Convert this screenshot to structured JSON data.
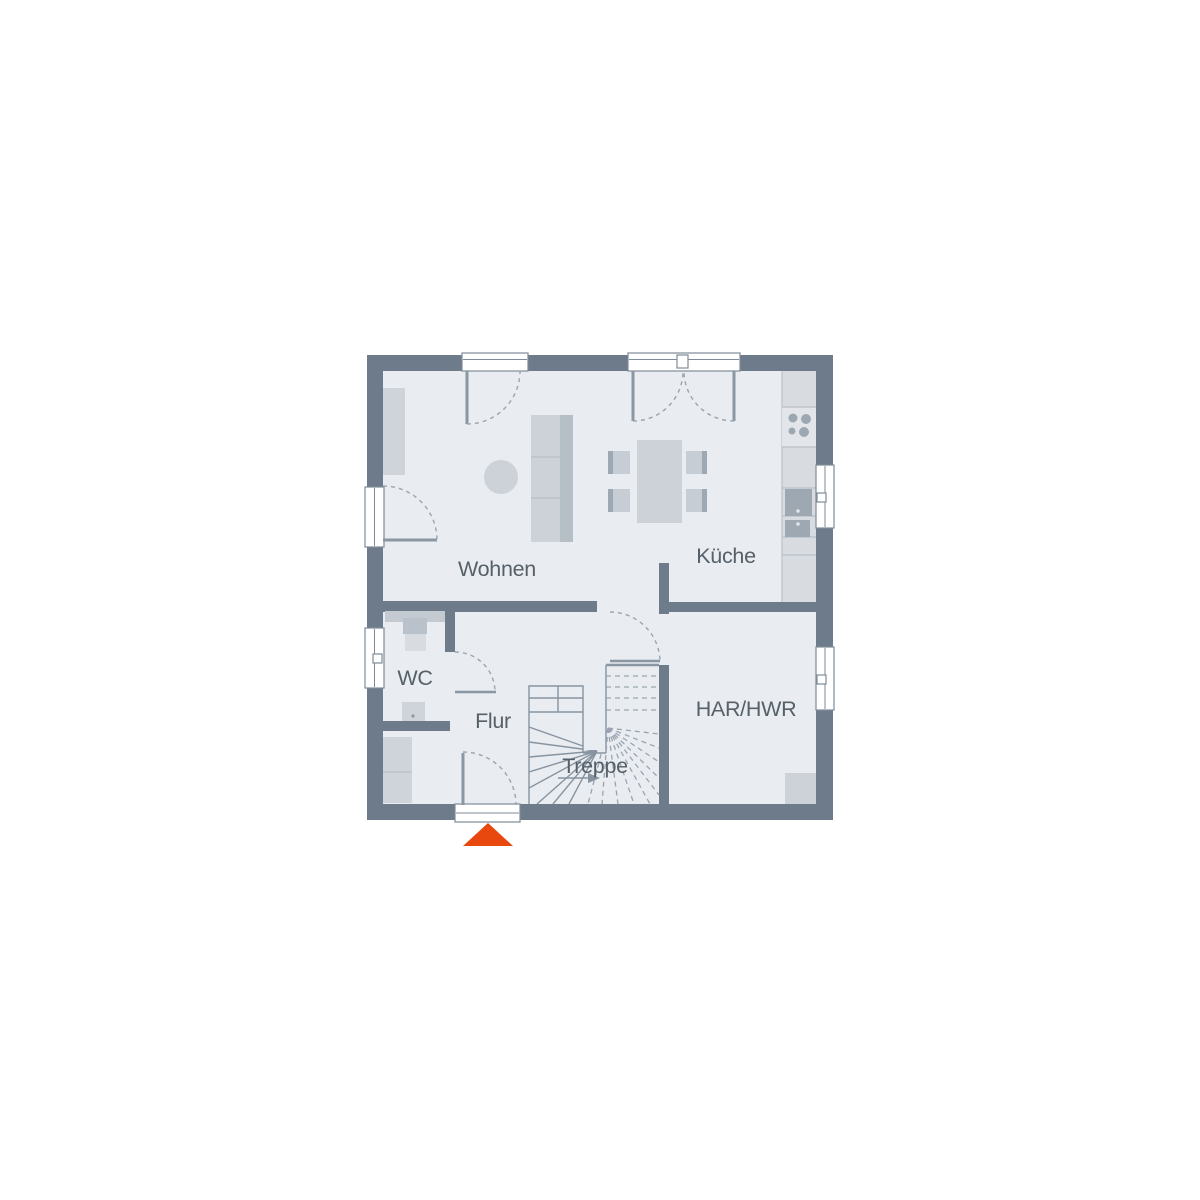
{
  "plan": {
    "type": "floor-plan-ground-floor",
    "rooms": {
      "wohnen": {
        "label": "Wohnen"
      },
      "kueche": {
        "label": "Küche"
      },
      "wc": {
        "label": "WC"
      },
      "flur": {
        "label": "Flur"
      },
      "treppe": {
        "label": "Treppe"
      },
      "har_hwr": {
        "label": "HAR/HWR"
      }
    },
    "colors": {
      "wall": "#6e7b8a",
      "floor": "#e9ecf0",
      "frame_line": "#7f8b98",
      "door_line": "#8a96a2",
      "arc_line": "#9aa5b1",
      "stair_line": "#8793a0",
      "stair_dash": "#9aa5b1",
      "furn_light": "#ced4da",
      "furn_mid": "#ccd2d8",
      "furn_back": "#b6bec6",
      "furn_dark": "#9ea8b2",
      "chair_light": "#c7cdd4",
      "counter": "#d8dce1",
      "cooktop_bg": "#e2e6ea",
      "burner": "#9da7b1",
      "fixture_band": "#c3cad1",
      "toilet_tank": "#b9c1ca",
      "toilet_bowl": "#d8dce0",
      "text": "#566069",
      "accent": "#e8480e"
    }
  }
}
